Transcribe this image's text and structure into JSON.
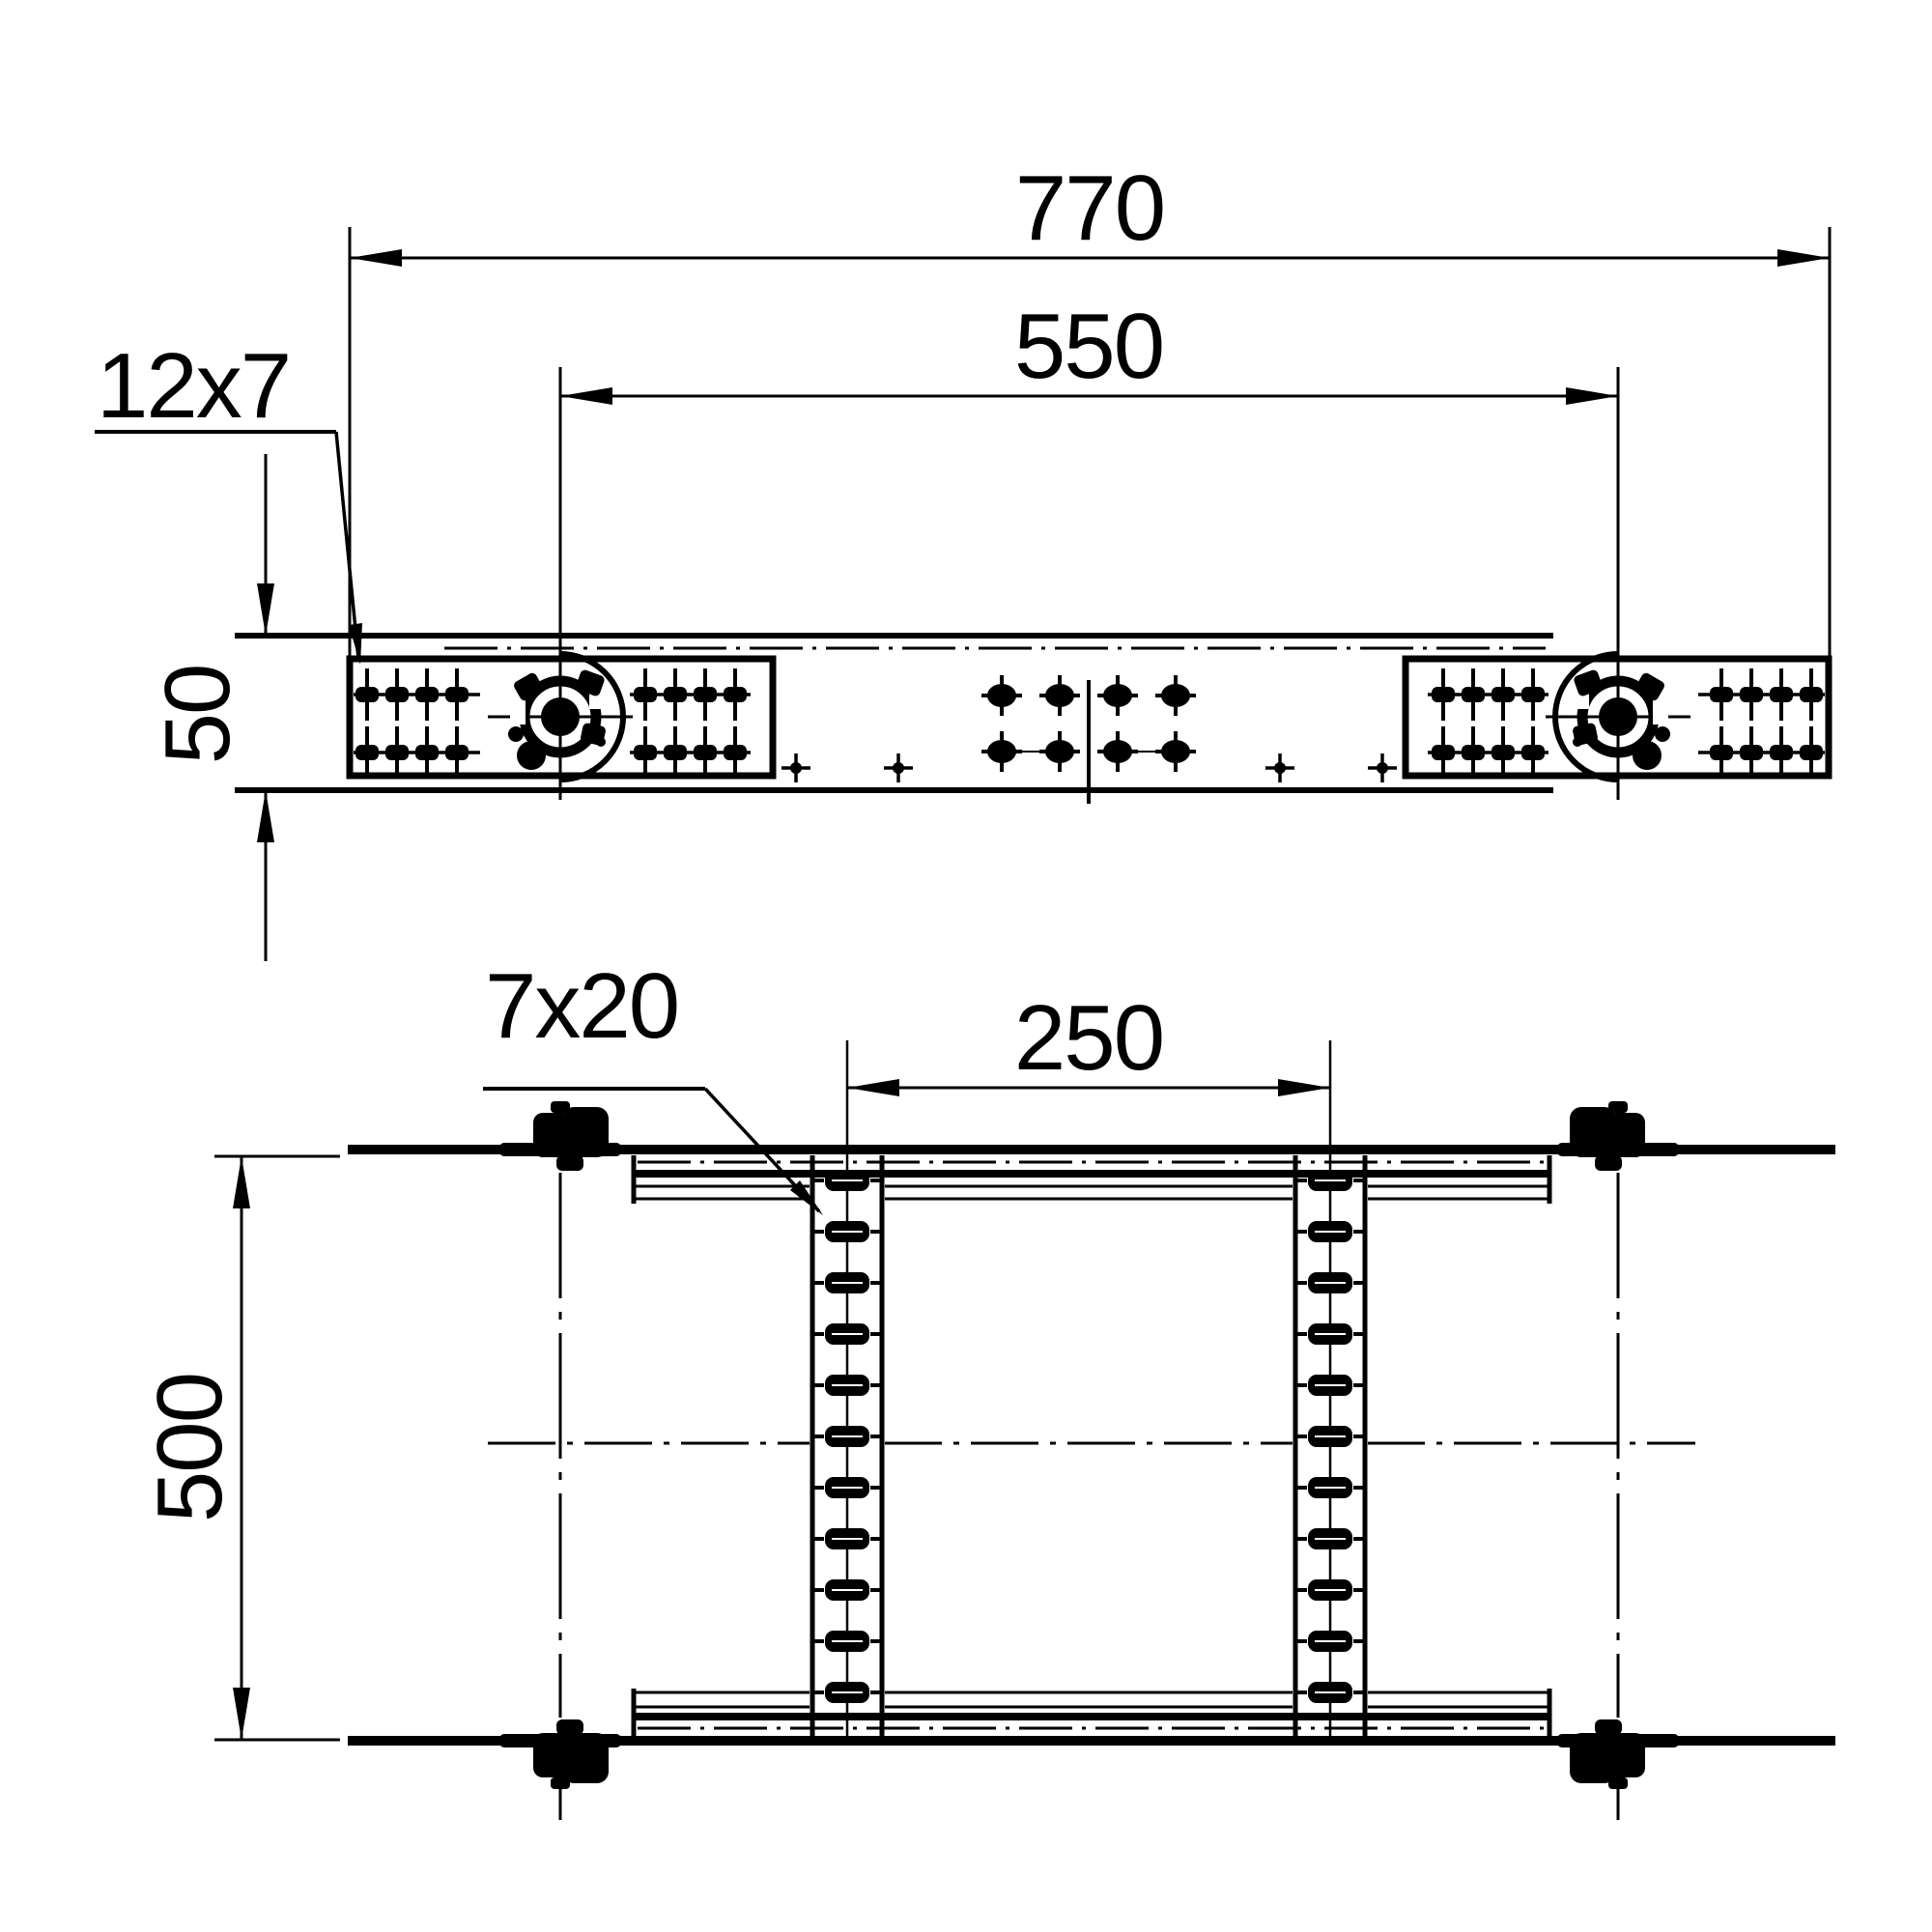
{
  "drawing": {
    "kind": "technical_drawing",
    "views": [
      {
        "id": "top-view",
        "description": "plan view of adjustable ladder coupler with pivot joints and slotted plates"
      },
      {
        "id": "front-view",
        "description": "front view with two slotted rung rails between ladder side rails"
      }
    ],
    "line_color": "#000000",
    "background_color": "#ffffff"
  },
  "dimensions": {
    "overall_length": "770",
    "pivot_spacing": "550",
    "slot_size_top": "12x7",
    "rail_height": "50",
    "slot_size_front": "7x20",
    "rung_spacing": "250",
    "ladder_width": "500"
  }
}
